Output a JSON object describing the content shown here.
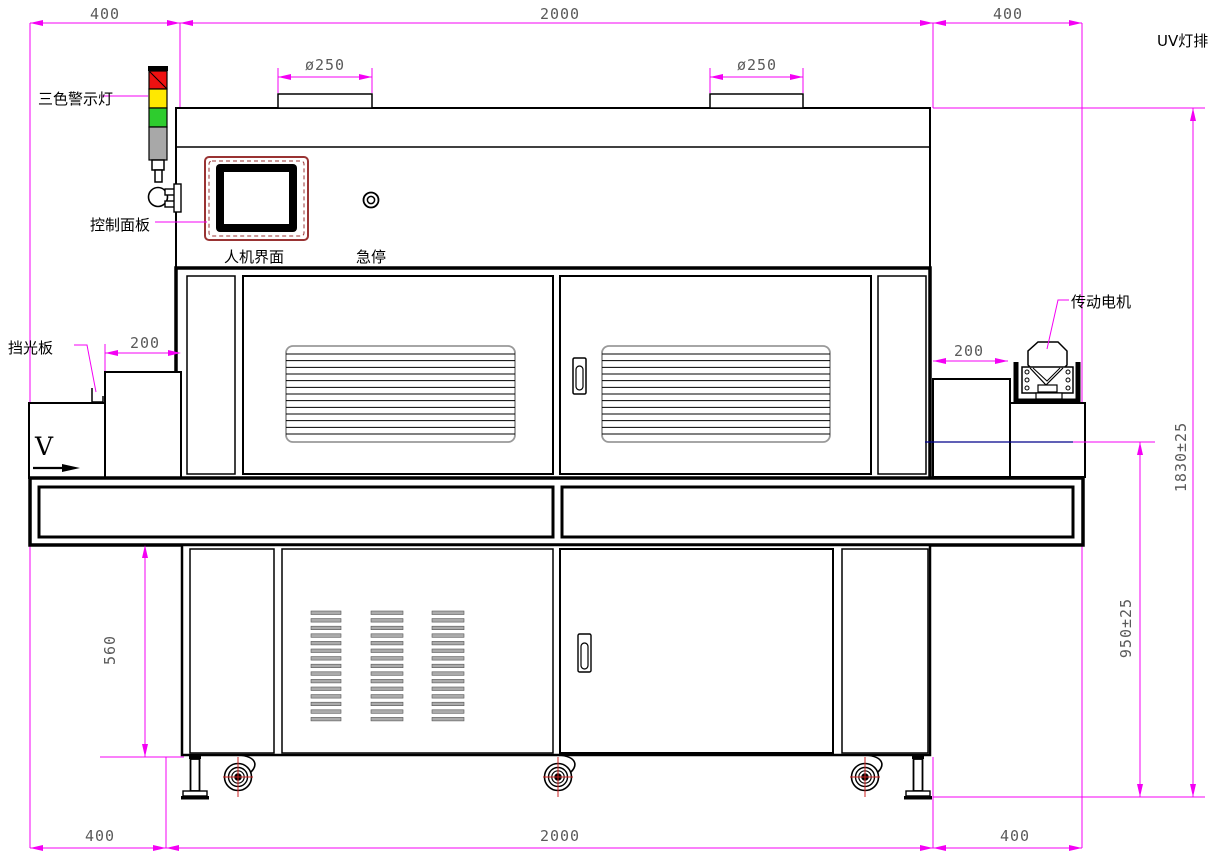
{
  "labels": {
    "tower_light": "三色警示灯",
    "control_panel": "控制面板",
    "hmi": "人机界面",
    "estop": "急停",
    "light_shield": "挡光板",
    "drive_motor": "传动电机",
    "uv_lamp_row": "UV灯排",
    "direction": "V"
  },
  "dimensions": {
    "top_left_400": "400",
    "top_center_2000": "2000",
    "top_right_400": "400",
    "chimney_dia_left": "ø250",
    "chimney_dia_right": "ø250",
    "infeed_200": "200",
    "outfeed_200": "200",
    "cabinet_height_560": "560",
    "belt_height_950": "950±25",
    "overall_height_1830": "1830±25",
    "bottom_left_400": "400",
    "bottom_center_2000": "2000",
    "bottom_right_400": "400"
  },
  "colors": {
    "dimension": "#f400f4",
    "dim_text": "#5a5a5a",
    "outline": "#000000",
    "hmi_border": "#993333",
    "tower_red": "#ee1111",
    "tower_yellow": "#ffe800",
    "tower_green": "#2ecc2e",
    "tower_gray": "#a8a8a8",
    "belt_level_line": "#00008b",
    "caster_cross": "#cc2222"
  }
}
